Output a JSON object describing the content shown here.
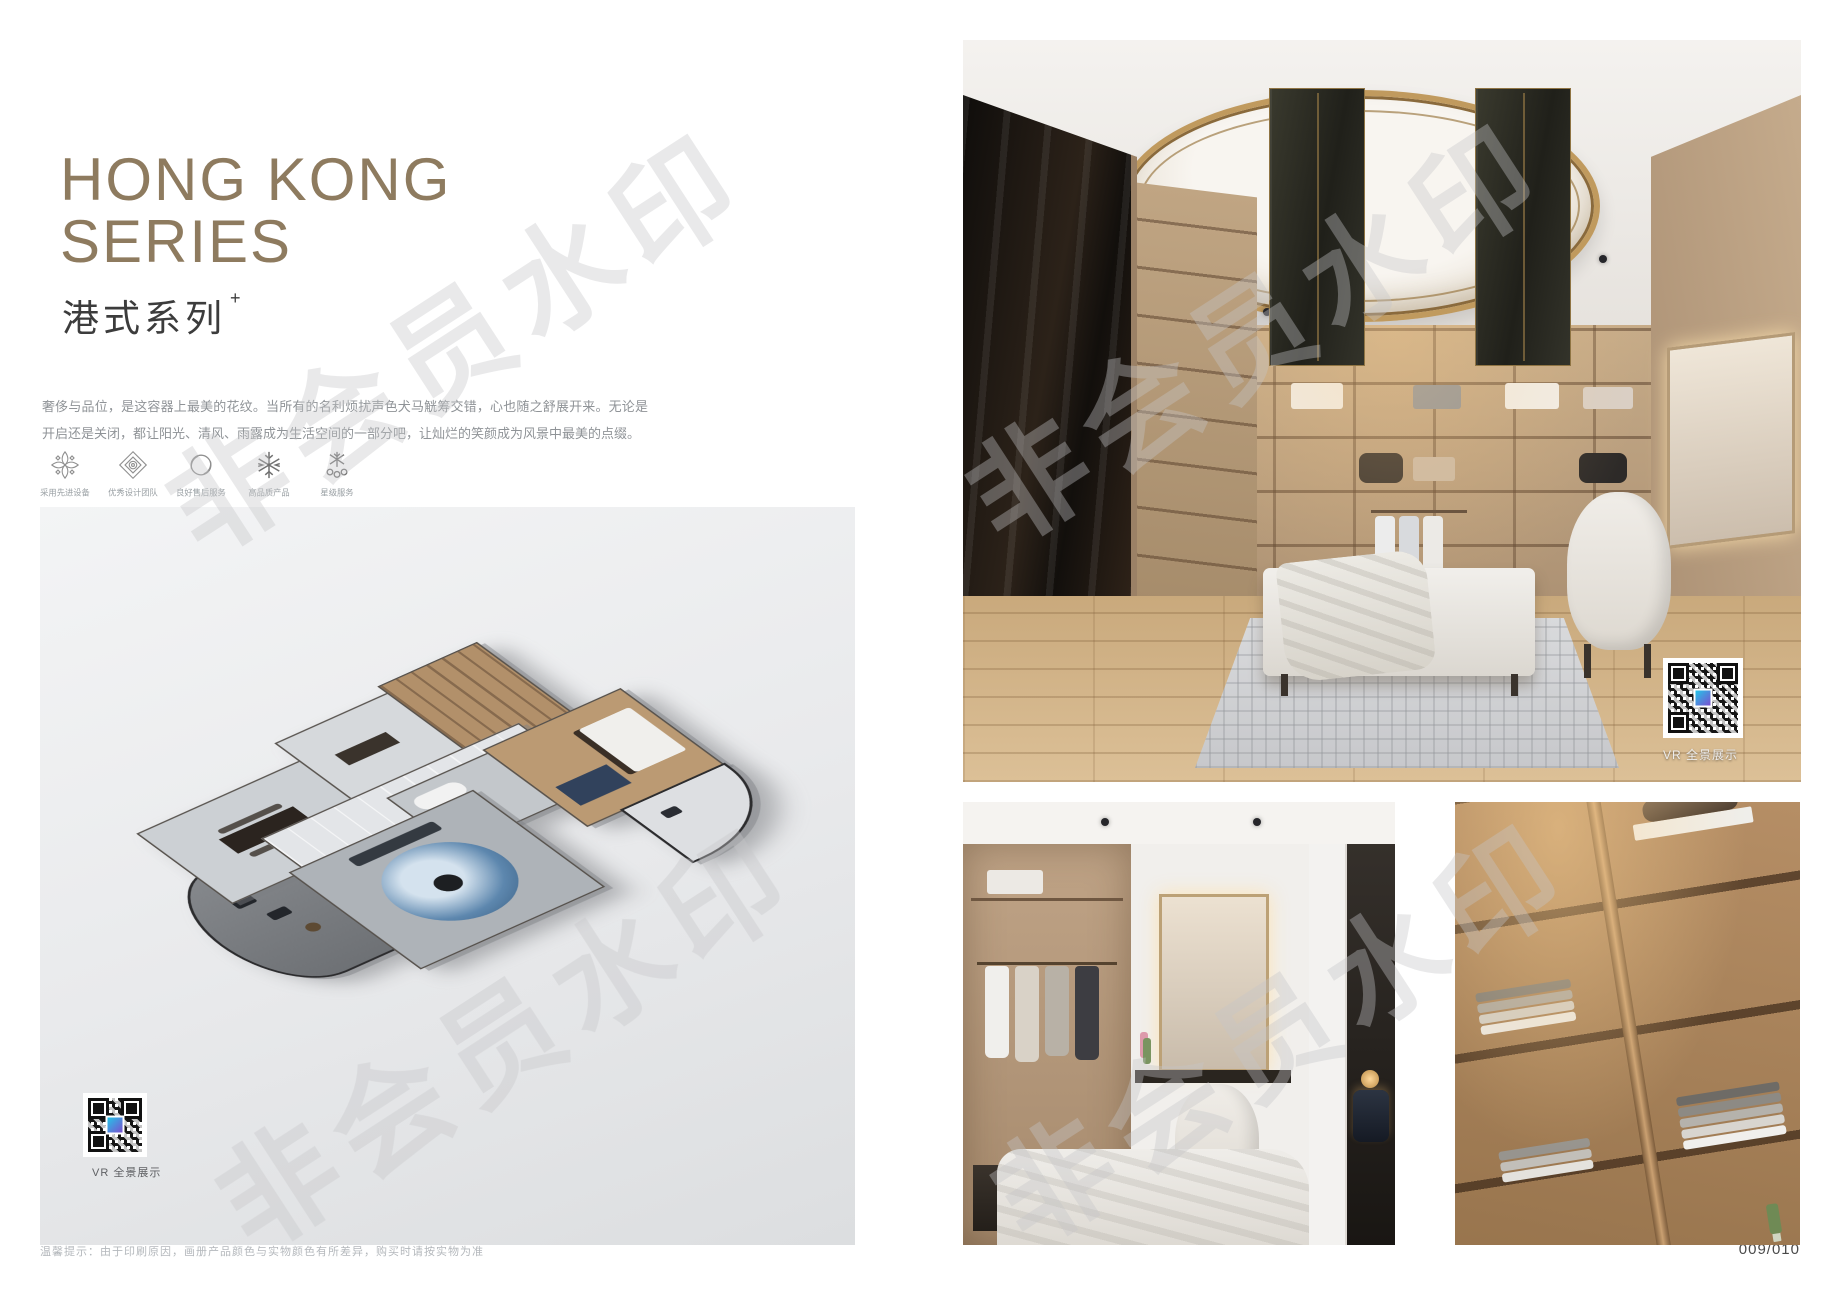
{
  "page": {
    "number": "009/010",
    "footnote": "温馨提示：由于印刷原因，画册产品颜色与实物颜色有所差异，购买时请按实物为准"
  },
  "watermark": {
    "text": "非会员水印"
  },
  "header": {
    "title_line1": "HONG KONG",
    "title_line2": "SERIES",
    "subtitle": "港式系列",
    "subtitle_sup": "+",
    "description": "奢侈与品位，是这容器上最美的花纹。当所有的名利烦扰声色犬马觥筹交错，心也随之舒展开来。无论是开启还是关闭，都让阳光、清风、雨露成为生活空间的一部分吧，让灿烂的笑颜成为风景中最美的点缀。"
  },
  "features": [
    {
      "icon": "clover-ornament-icon",
      "label": "采用先进设备"
    },
    {
      "icon": "diamond-ornament-icon",
      "label": "优秀设计团队"
    },
    {
      "icon": "circle-brush-icon",
      "label": "良好售后服务"
    },
    {
      "icon": "snowflake-icon",
      "label": "高品质产品"
    },
    {
      "icon": "star-service-icon",
      "label": "星级服务"
    }
  ],
  "floorplan": {
    "vr_label": "VR 全景展示"
  },
  "hero": {
    "vr_label": "VR 全景展示"
  },
  "colors": {
    "title_bronze": "#8e7b5f",
    "gold_trim": "#c09a5e",
    "page_bg": "#ffffff",
    "floorplan_bg": "#e9eaec",
    "qr_logo_cyan": "#23c6e8",
    "qr_logo_purple": "#7a4fd0"
  }
}
